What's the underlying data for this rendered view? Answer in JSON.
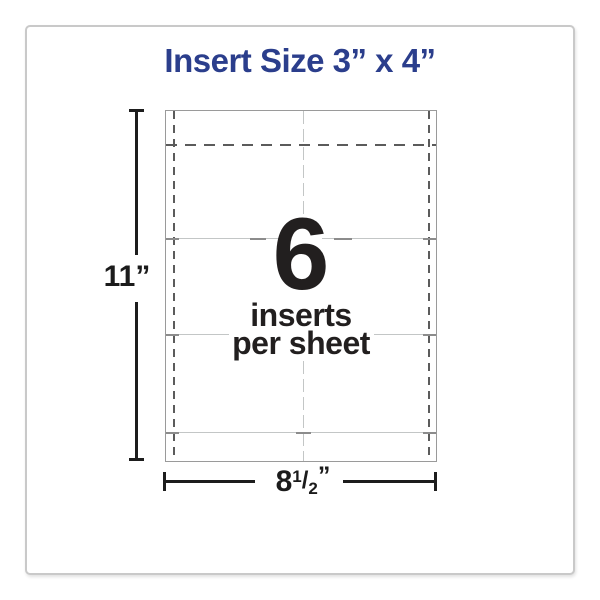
{
  "title": "Insert Size 3” x 4”",
  "sheet_diagram": {
    "inserts_count": "6",
    "caption_line1": "inserts",
    "caption_line2": "per sheet"
  },
  "dimensions": {
    "height": {
      "label": "11”"
    },
    "width": {
      "whole": "8",
      "fraction_numerator": "1",
      "fraction_slash": "/",
      "fraction_denominator": "2",
      "unit": "”"
    }
  },
  "colors": {
    "title_blue": "#2b3e8c",
    "text_black": "#221f1f",
    "sheet_border_gray": "#9a9a9a",
    "perforation_dark_gray": "#5b5b5b",
    "cut_line_light_gray": "#c3c6c6",
    "frame_border_gray": "#c9c9c9"
  }
}
